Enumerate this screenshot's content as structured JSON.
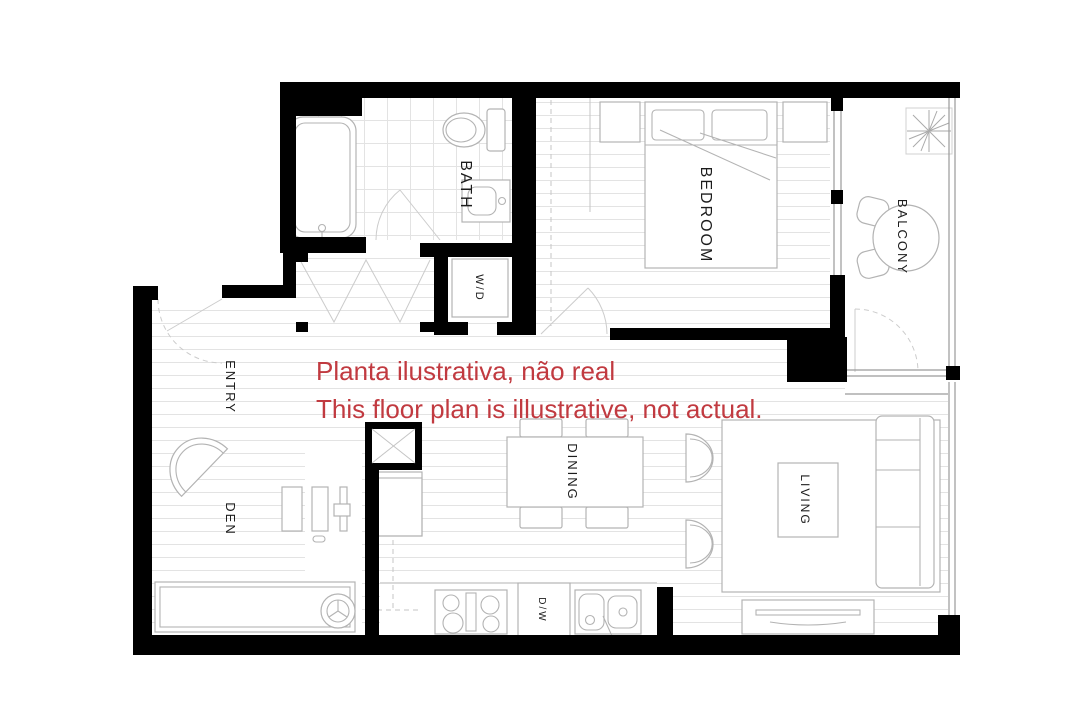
{
  "plan": {
    "colors": {
      "wall": "#000000",
      "furniture_line": "#b3b3b3",
      "floor_line": "#e3e3e3",
      "annotation": "#c13a40"
    },
    "rooms": {
      "bath": "BATH",
      "laundry": "W/D",
      "bedroom": "BEDROOM",
      "balcony": "BALCONY",
      "entry": "ENTRY",
      "den": "DEN",
      "dining": "DINING",
      "living": "LIVING",
      "dishwasher": "D/W"
    },
    "annotation": {
      "line1": "Planta ilustrativa, não real",
      "line2": "This floor plan is illustrative, not actual.",
      "color": "#c13a40"
    }
  }
}
